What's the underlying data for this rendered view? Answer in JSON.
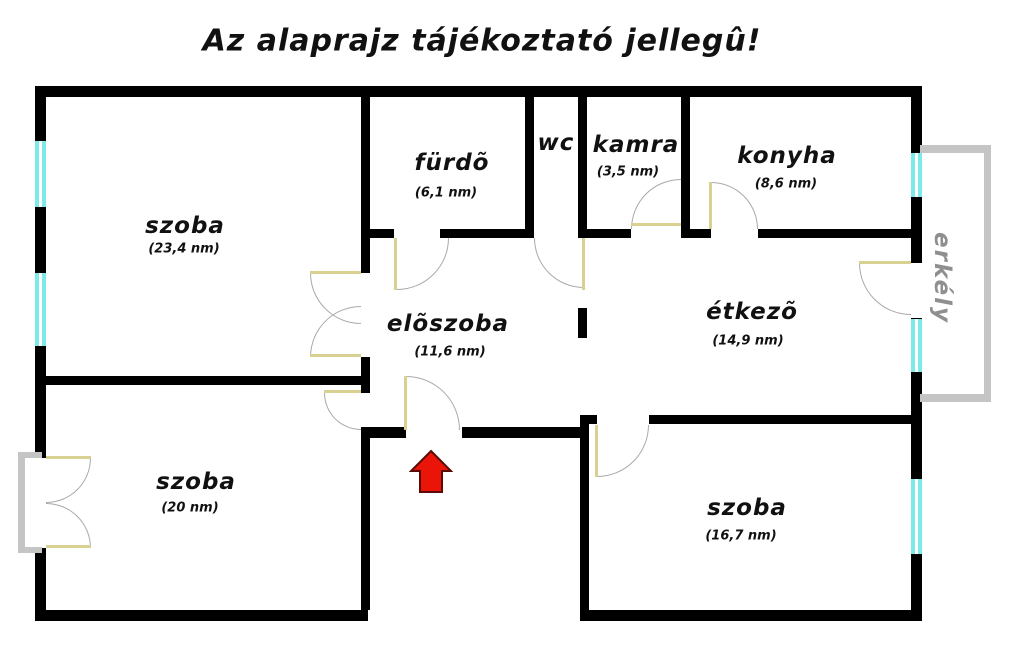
{
  "title": "Az alaprajz tájékoztató jellegû!",
  "rooms": {
    "szoba_nagy": {
      "label": "szoba",
      "area": "(23,4 nm)"
    },
    "furdo": {
      "label": "fürdõ",
      "area": "(6,1 nm)"
    },
    "wc": {
      "label": "wc"
    },
    "kamra": {
      "label": "kamra",
      "area": "(3,5 nm)"
    },
    "konyha": {
      "label": "konyha",
      "area": "(8,6 nm)"
    },
    "eloszoba": {
      "label": "elõszoba",
      "area": "(11,6 nm)"
    },
    "etkezo": {
      "label": "étkezõ",
      "area": "(14,9 nm)"
    },
    "szoba_bal": {
      "label": "szoba",
      "area": "(20 nm)"
    },
    "szoba_jobb": {
      "label": "szoba",
      "area": "(16,7 nm)"
    },
    "erkely": {
      "label": "erkély"
    }
  },
  "icons": {
    "entrance_marker": "red-arrow-up-icon"
  },
  "colors": {
    "wall": "#000000",
    "window": "#7de9e9",
    "balcony_outline": "#c5c5c5",
    "door_leaf": "#d8d191",
    "door_arc": "#a9a9a9",
    "entrance_arrow_fill": "#ea1408",
    "entrance_arrow_border": "#5a0b06",
    "balcony_text": "#8f8f8f"
  }
}
